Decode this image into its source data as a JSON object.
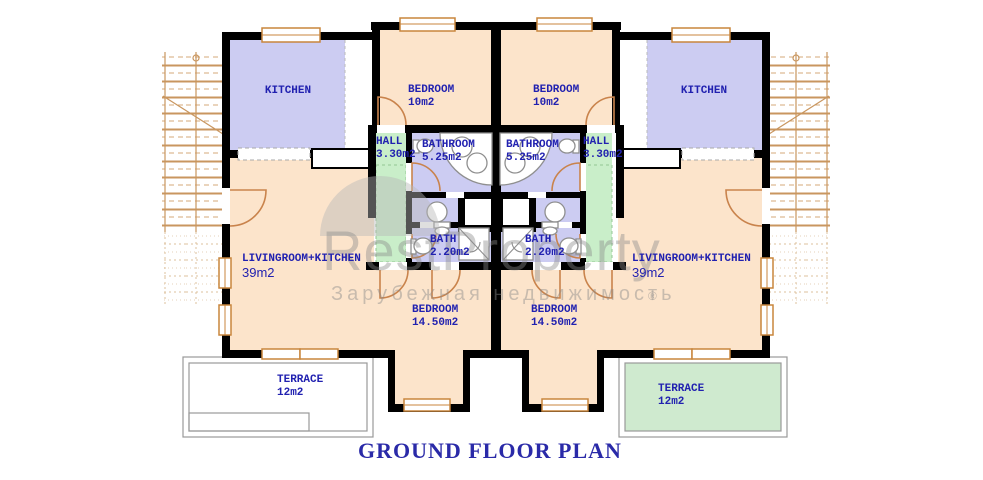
{
  "title": "GROUND FLOOR PLAN",
  "watermark": {
    "brand": "RestProperty",
    "tagline": "Зарубежная недвижимость",
    "registered": "®"
  },
  "units": {
    "left": {
      "kitchen": {
        "name": "KITCHEN"
      },
      "bedroom_small": {
        "name": "BEDROOM",
        "area": "10m2"
      },
      "hall": {
        "name": "HALL",
        "area": "3.30m2"
      },
      "bathroom": {
        "name": "BATHROOM",
        "area": "5.25m2"
      },
      "bath": {
        "name": "BATH",
        "area": "2.20m2"
      },
      "living": {
        "name": "LIVINGROOM+KITCHEN",
        "area": "39m2"
      },
      "bedroom_large": {
        "name": "BEDROOM",
        "area": "14.50m2"
      },
      "terrace": {
        "name": "TERRACE",
        "area": "12m2"
      }
    },
    "right": {
      "kitchen": {
        "name": "KITCHEN"
      },
      "bedroom_small": {
        "name": "BEDROOM",
        "area": "10m2"
      },
      "hall": {
        "name": "HALL",
        "area": "3.30m2"
      },
      "bathroom": {
        "name": "BATHROOM",
        "area": "5.25m2"
      },
      "bath": {
        "name": "BATH",
        "area": "2.20m2"
      },
      "living": {
        "name": "LIVINGROOM+KITCHEN",
        "area": "39m2"
      },
      "bedroom_large": {
        "name": "BEDROOM",
        "area": "14.50m2"
      },
      "terrace": {
        "name": "TERRACE",
        "area": "12m2"
      }
    }
  },
  "colors": {
    "wall": "#000000",
    "lavender": "#ccccf2",
    "peach": "#fce4cb",
    "hall_green": "#c9eec9",
    "terrace_green": "#cfeacf",
    "door_tan": "#c9834c",
    "window_tan": "#c8853c",
    "stair_tan": "#c9965f",
    "label_navy": "#2121b0",
    "title_navy": "#2a2aa8",
    "terrace_border": "#999999",
    "watermark_gray": "#8c8c8c"
  }
}
